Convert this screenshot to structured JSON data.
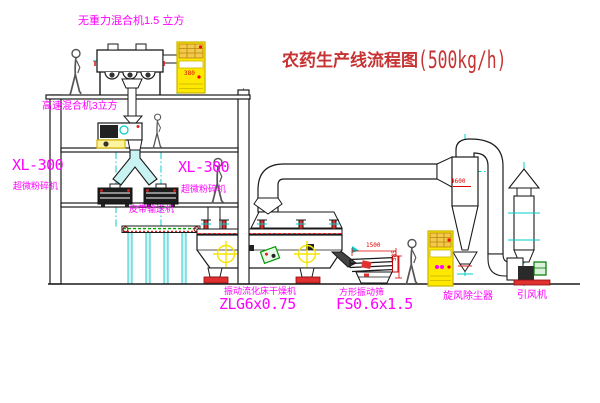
{
  "title": {
    "text": "农药生产线流程图",
    "capacity": "(500kg/h)"
  },
  "equipment_labels": {
    "gravity_mixer": "无重力混合机1.5 立方",
    "high_speed_mixer": "高速混合机3立方",
    "left_mill": {
      "model": "XL-300",
      "name": "超微粉碎机"
    },
    "mid_mill": {
      "model": "XL-300",
      "name": "超微粉碎机"
    },
    "belt_conveyor": "皮带输送机",
    "fluid_bed_dryer": {
      "name": "振动流化床干燥机",
      "model": "ZLG6x0.75"
    },
    "vibrating_screen": {
      "name": "方形振动筛",
      "model": "FS0.6x1.5"
    },
    "cyclone": "旋风除尘器",
    "induced_draft_fan": "引风机"
  },
  "dimensions": {
    "screen_length": "1500",
    "screen_height": "585",
    "cyclone_mark": "Φ600",
    "cabinet_mark": "380"
  },
  "colors": {
    "label_magenta": "#FF00FF",
    "title_red": "#C63333",
    "line_teal": "#00CCCC",
    "cabinet_yellow": "#FFE800",
    "accent_red": "#EE2222",
    "accent_green": "#00AA00",
    "crosshair_yellow": "#F5E400"
  }
}
